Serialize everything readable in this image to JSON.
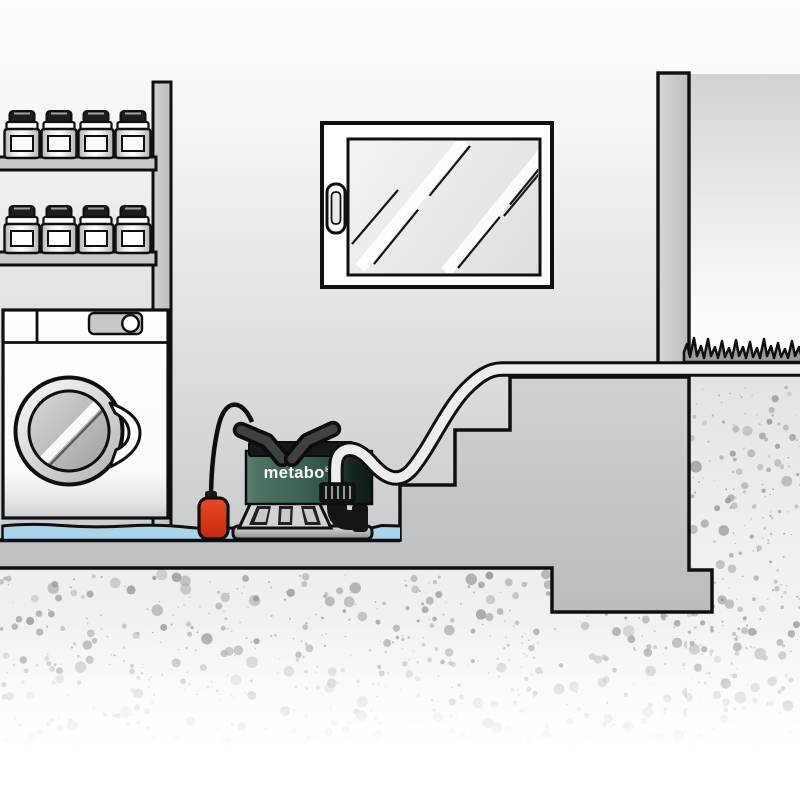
{
  "scene": {
    "name": "metabo-submersible-pump-flooded-basement-illustration",
    "brand_label": "metabo",
    "trademark_symbol": "®",
    "objects": {
      "shelf_unit": {
        "shelves": 2,
        "jars_per_shelf": 4,
        "jars_total": 8
      },
      "window": {
        "reflection_stripes": 2,
        "handle": true
      },
      "washing_machine": {
        "porthole_door": true,
        "control_knob": true,
        "door_handle": true
      },
      "pump": {
        "brand_label_on_body": true,
        "carry_handle": true,
        "float_switch": true,
        "outlet_elbow": true,
        "hose_coupling": true
      },
      "drain_hose": {
        "runs_over_stairs": true,
        "exits_at_ground_level": true
      },
      "staircase": {
        "steps": 3
      },
      "flood_water": true,
      "grass_patch": true,
      "soil_cross_section": true,
      "house_wall": true
    },
    "palette": {
      "outline_black": "#0f0f10",
      "structure_gray": "#c6c7c9",
      "pump_green": "#3b6254",
      "float_red": "#dc3517",
      "water_blue": "#abd4ea",
      "hose_light": "#ededee",
      "grass_gray": "#9a9c9d",
      "soil_speckle_gray": "#a9abac",
      "background_top_white": "#fdfdfd"
    },
    "speckles": {
      "region_left": 760,
      "region_right": 300
    }
  }
}
